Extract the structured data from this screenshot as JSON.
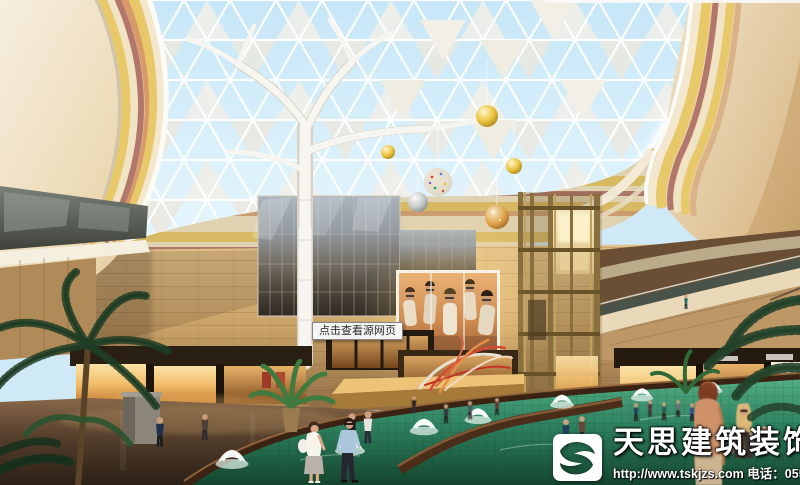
{
  "window": {
    "width": 800,
    "height": 485,
    "description": "3D architectural rendering of a shopping mall atrium: triangulated glass dome, white tree column, LED fashion billboard, shops, fountains pond and shoppers"
  },
  "overlay": {
    "source_tooltip": "点击查看源网页"
  },
  "billboard": {
    "brand": "A|X"
  },
  "watermark": {
    "company": "天思建筑装饰",
    "url": "http://www.tskjzs.com",
    "phone_label": " 电话：",
    "phone": "0551-65568226"
  },
  "icons": {
    "logo": "s-swoosh-logo"
  },
  "colors": {
    "sky": "#cde9f7",
    "dome_frame": "#ffffff",
    "dome_panel": "#f2efe7",
    "cream": "#f3e8cd",
    "stripe_yellow": "#e7c96a",
    "stripe_maroon": "#b3766b",
    "stone_wall": "#cda771",
    "shop_glow": "#f7c473",
    "bronze_elevator": "#9a7d46",
    "screen_warm": "#d89058",
    "pond_green": "#2f7f5f",
    "pond_edge": "#3a2312",
    "floor_brown": "#5d4630",
    "watermark_text": "#ffffff",
    "tooltip_bg": "#f4f4f4"
  }
}
